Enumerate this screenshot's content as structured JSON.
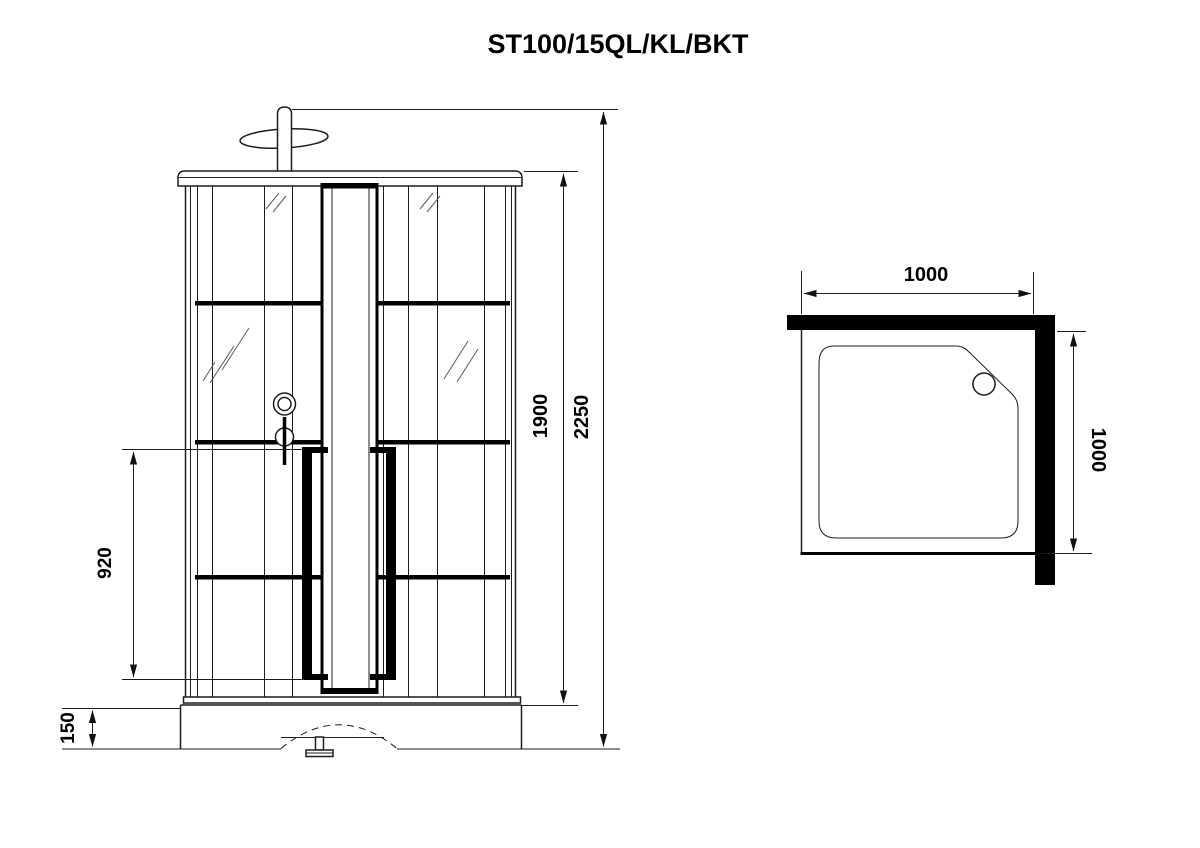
{
  "title": "ST100/15QL/KL/BKT",
  "front_view": {
    "label": "front elevation of shower cabin",
    "dims": {
      "total_height": "2250",
      "cabin_height": "1900",
      "handle_length": "920",
      "tray_height": "150"
    }
  },
  "top_view": {
    "label": "plan view of shower tray",
    "dims": {
      "width": "1000",
      "depth": "1000"
    }
  }
}
